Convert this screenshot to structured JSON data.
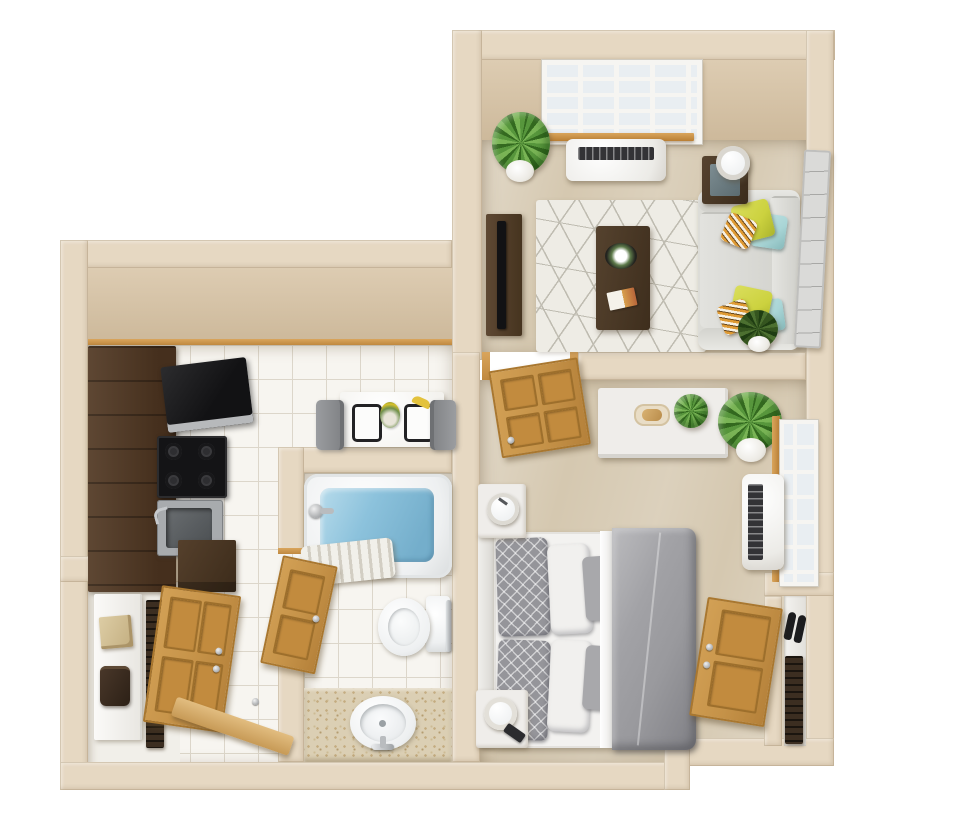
{
  "scene": {
    "type": "3d-floor-plan",
    "description": "Top-down 3D rendering of a one-bedroom, one-bathroom apartment on a white background. No text labels are rendered in the image.",
    "background": "#ffffff"
  },
  "palette": {
    "wall": "#e6d8c2",
    "wallFace": "#ddccb2",
    "wallFaceDark": "#cdb99b",
    "trimWood": "#c08940",
    "carpet": "#d5c8b0",
    "tile": "#f7f5f0",
    "grout": "#dcd6ca",
    "nicheFloor": "#f1efe9",
    "cabinet": "#4f3b2a",
    "applianceBlack": "#1a1a1c",
    "steel": "#a8abae",
    "waterBlue": "#8cc2dc",
    "doorWood": "#c59248",
    "doorWoodDark": "#a9772f",
    "rugBase": "#eeece5",
    "rugLine": "#bfbcb1",
    "sofa": "#dcdcd7",
    "pillowYellow": "#ccd23f",
    "pillowBlue": "#a9d5d6",
    "pillowStripe": "#df9a33",
    "duvetGray": "#a2a2a6",
    "pillowGray": "#95959a",
    "linenWhite": "#f1f0ee",
    "furnitureWhite": "#efedea",
    "plantGreen": "#57963c",
    "plantGreenDark": "#33691f",
    "potWhite": "#eceae4",
    "vanity": "#dbcfb4",
    "porcelain": "#eef0f1",
    "tvBlack": "#121214"
  },
  "rooms": [
    {
      "name": "living-room",
      "floor": "beige carpet",
      "furniture": [
        "gridded-window",
        "wood-window-sill",
        "wall-air-conditioner",
        "potted-plant",
        "tv-stand",
        "flat-tv",
        "geometric-area-rug",
        "coffee-table",
        "flower-bowl",
        "magazine",
        "three-seat-sofa",
        "yellow-pillows",
        "blue-pillows",
        "striped-pillows",
        "side-table",
        "table-lamp",
        "wall-art-panel",
        "corner-plant"
      ]
    },
    {
      "name": "kitchen",
      "floor": "white tile",
      "furniture": [
        "dark-cabinet-run",
        "microwave",
        "stove-with-burners",
        "stainless-sink",
        "lower-cabinet",
        "dining-table",
        "placemats",
        "flower-vase",
        "banana",
        "two-chairs"
      ]
    },
    {
      "name": "bathroom",
      "floor": "white tile",
      "furniture": [
        "bathtub-with-water",
        "tub-faucet",
        "shower-curtain",
        "wood-door",
        "toilet-with-tank",
        "grab-bar",
        "speckled-vanity",
        "round-sink",
        "sink-faucet"
      ]
    },
    {
      "name": "bedroom",
      "floor": "beige carpet",
      "furniture": [
        "wood-door",
        "white-dresser",
        "serving-tray",
        "dresser-plant",
        "large-potted-plant",
        "gridded-window",
        "wall-air-conditioner",
        "bed-with-gray-duvet",
        "patterned-pillows",
        "white-pillows",
        "headboard",
        "nightstand-with-clock",
        "nightstand-with-lamp",
        "phone",
        "closet",
        "closet-wood-door",
        "slippers",
        "shoe-rack"
      ]
    },
    {
      "name": "entry",
      "floor": "white tile",
      "furniture": [
        "console-table",
        "storage-box",
        "bag",
        "slat-rack",
        "entry-wood-door",
        "threshold-plank",
        "floor-stop"
      ]
    }
  ]
}
